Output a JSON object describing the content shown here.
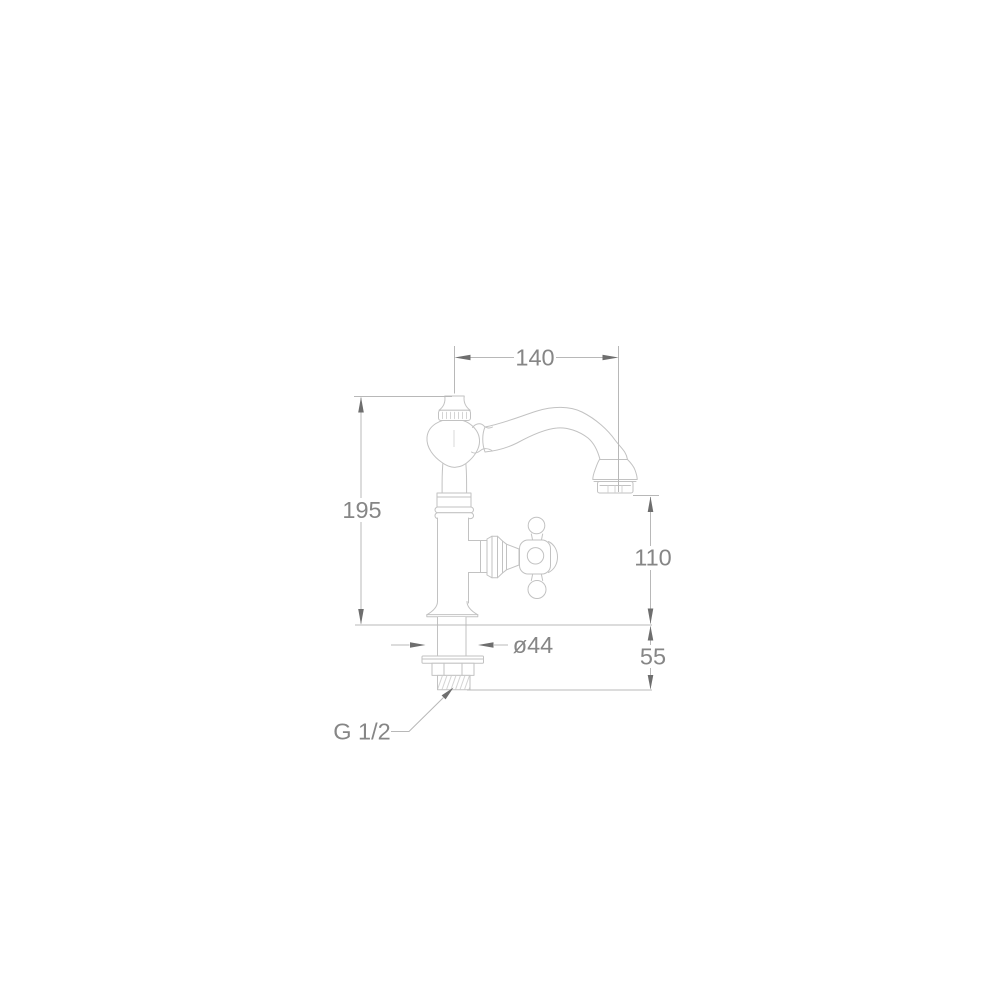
{
  "diagram": {
    "kind": "technical-dimension-drawing",
    "subject": "classic single-hole pillar basin tap, side elevation",
    "units": "mm",
    "colors": {
      "background": "#ffffff",
      "object_line": "#c2c2c2",
      "dimension_line": "#b8b8b8",
      "arrow": "#6e6e6e",
      "label_text": "#868686"
    },
    "dimensions": {
      "spout_reach": {
        "label": "140",
        "orientation": "horizontal",
        "position": "top"
      },
      "overall_height": {
        "label": "195",
        "orientation": "vertical",
        "position": "left"
      },
      "outlet_height": {
        "label": "110",
        "orientation": "vertical",
        "position": "right"
      },
      "under_deck": {
        "label": "55",
        "orientation": "vertical",
        "position": "lower-right"
      },
      "base_diameter": {
        "label": "ø44",
        "orientation": "horizontal",
        "position": "base"
      },
      "inlet_thread": {
        "label": "G 1/2",
        "orientation": "leader-note",
        "position": "bottom-left"
      }
    }
  }
}
